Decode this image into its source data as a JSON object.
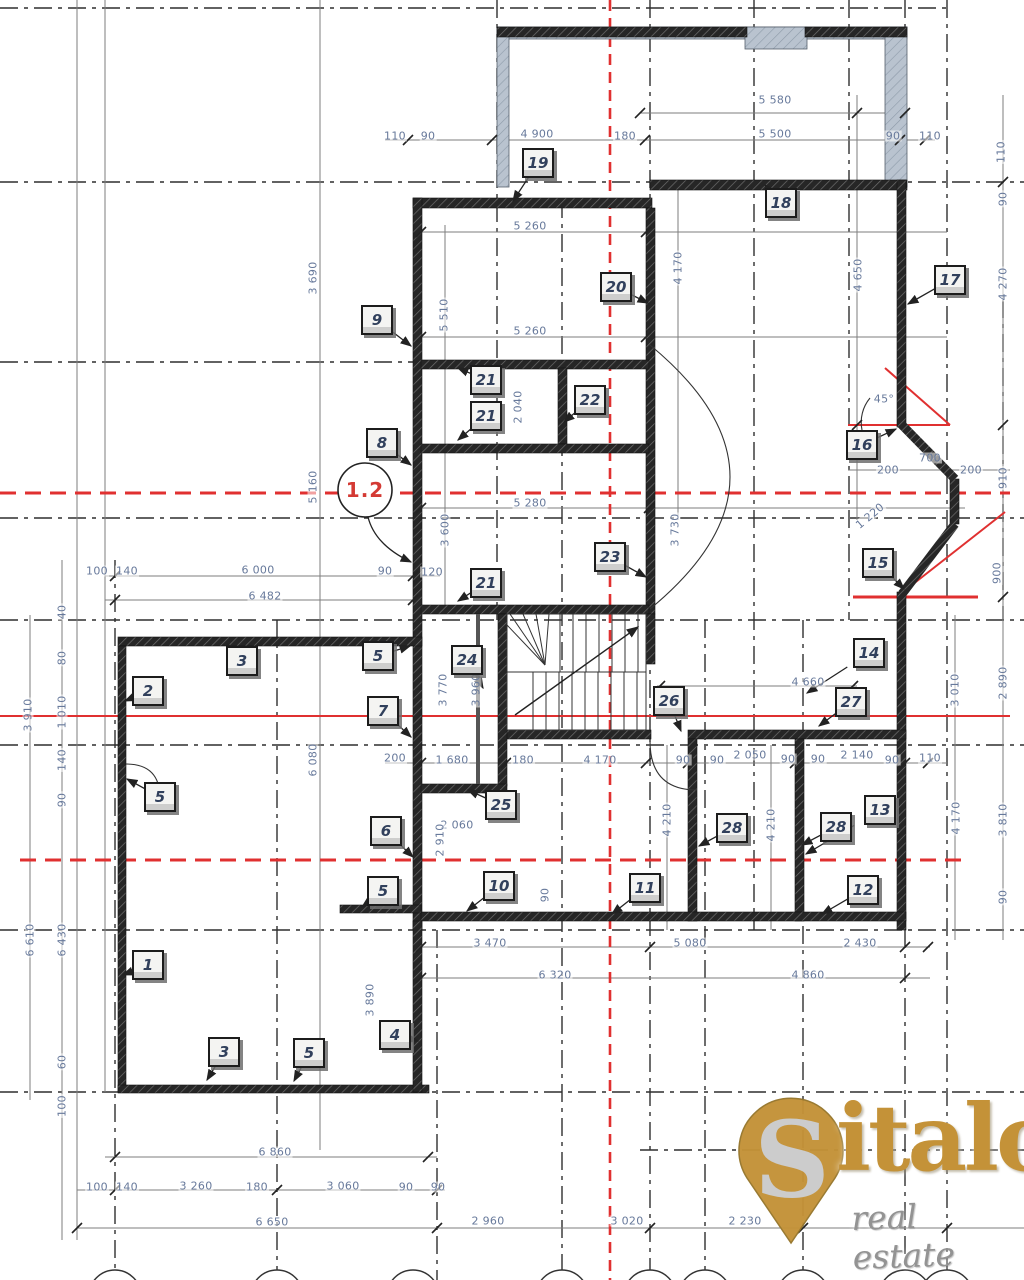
{
  "drawing": {
    "axis_bubble": {
      "label": "1.2"
    },
    "angle_note": "45°",
    "colors": {
      "wall": "#262626",
      "window_wall": "#b9c3cf",
      "axis_red": "#e03030",
      "dim_text": "#67799b",
      "grid": "#2f2f2f"
    },
    "dims": [
      {
        "t": "5 580",
        "x": 775,
        "y": 100,
        "o": "h"
      },
      {
        "t": "110",
        "x": 395,
        "y": 136,
        "o": "h"
      },
      {
        "t": "90",
        "x": 428,
        "y": 136,
        "o": "h"
      },
      {
        "t": "4 900",
        "x": 537,
        "y": 134,
        "o": "h"
      },
      {
        "t": "180",
        "x": 625,
        "y": 136,
        "o": "h"
      },
      {
        "t": "5 500",
        "x": 775,
        "y": 134,
        "o": "h"
      },
      {
        "t": "90",
        "x": 893,
        "y": 136,
        "o": "h"
      },
      {
        "t": "110",
        "x": 930,
        "y": 136,
        "o": "h"
      },
      {
        "t": "5 260",
        "x": 530,
        "y": 226,
        "o": "h"
      },
      {
        "t": "5 260",
        "x": 530,
        "y": 331,
        "o": "h"
      },
      {
        "t": "5 280",
        "x": 530,
        "y": 503,
        "o": "h"
      },
      {
        "t": "100",
        "x": 97,
        "y": 571,
        "o": "h"
      },
      {
        "t": "140",
        "x": 127,
        "y": 571,
        "o": "h"
      },
      {
        "t": "6 000",
        "x": 258,
        "y": 570,
        "o": "h"
      },
      {
        "t": "90",
        "x": 385,
        "y": 571,
        "o": "h"
      },
      {
        "t": "120",
        "x": 432,
        "y": 572,
        "o": "h"
      },
      {
        "t": "6 482",
        "x": 265,
        "y": 596,
        "o": "h"
      },
      {
        "t": "700",
        "x": 930,
        "y": 458,
        "o": "h"
      },
      {
        "t": "200",
        "x": 888,
        "y": 470,
        "o": "h"
      },
      {
        "t": "200",
        "x": 971,
        "y": 470,
        "o": "h"
      },
      {
        "t": "45°",
        "x": 884,
        "y": 399,
        "o": "h"
      },
      {
        "t": "4 660",
        "x": 808,
        "y": 682,
        "o": "h"
      },
      {
        "t": "200",
        "x": 395,
        "y": 758,
        "o": "h"
      },
      {
        "t": "1 680",
        "x": 452,
        "y": 760,
        "o": "h"
      },
      {
        "t": "180",
        "x": 523,
        "y": 760,
        "o": "h"
      },
      {
        "t": "4 170",
        "x": 600,
        "y": 760,
        "o": "h"
      },
      {
        "t": "90",
        "x": 683,
        "y": 760,
        "o": "h"
      },
      {
        "t": "90",
        "x": 717,
        "y": 760,
        "o": "h"
      },
      {
        "t": "2 050",
        "x": 750,
        "y": 755,
        "o": "h"
      },
      {
        "t": "90",
        "x": 788,
        "y": 759,
        "o": "h"
      },
      {
        "t": "90",
        "x": 818,
        "y": 759,
        "o": "h"
      },
      {
        "t": "2 140",
        "x": 857,
        "y": 755,
        "o": "h"
      },
      {
        "t": "90",
        "x": 892,
        "y": 760,
        "o": "h"
      },
      {
        "t": "110",
        "x": 930,
        "y": 758,
        "o": "h"
      },
      {
        "t": "2 060",
        "x": 457,
        "y": 825,
        "o": "h"
      },
      {
        "t": "3 470",
        "x": 490,
        "y": 943,
        "o": "h"
      },
      {
        "t": "5 080",
        "x": 690,
        "y": 943,
        "o": "h"
      },
      {
        "t": "2 430",
        "x": 860,
        "y": 943,
        "o": "h"
      },
      {
        "t": "6 320",
        "x": 555,
        "y": 975,
        "o": "h"
      },
      {
        "t": "4 860",
        "x": 808,
        "y": 975,
        "o": "h"
      },
      {
        "t": "6 860",
        "x": 275,
        "y": 1152,
        "o": "h"
      },
      {
        "t": "100",
        "x": 97,
        "y": 1187,
        "o": "h"
      },
      {
        "t": "140",
        "x": 127,
        "y": 1187,
        "o": "h"
      },
      {
        "t": "3 260",
        "x": 196,
        "y": 1186,
        "o": "h"
      },
      {
        "t": "180",
        "x": 257,
        "y": 1187,
        "o": "h"
      },
      {
        "t": "3 060",
        "x": 343,
        "y": 1186,
        "o": "h"
      },
      {
        "t": "90",
        "x": 406,
        "y": 1187,
        "o": "h"
      },
      {
        "t": "90",
        "x": 438,
        "y": 1187,
        "o": "h"
      },
      {
        "t": "6 650",
        "x": 272,
        "y": 1222,
        "o": "h"
      },
      {
        "t": "2 960",
        "x": 488,
        "y": 1221,
        "o": "h"
      },
      {
        "t": "3 020",
        "x": 627,
        "y": 1221,
        "o": "h"
      },
      {
        "t": "2 230",
        "x": 745,
        "y": 1221,
        "o": "h"
      },
      {
        "t": "3 690",
        "x": 313,
        "y": 278,
        "o": "v"
      },
      {
        "t": "5 510",
        "x": 444,
        "y": 315,
        "o": "v"
      },
      {
        "t": "4 170",
        "x": 678,
        "y": 268,
        "o": "v"
      },
      {
        "t": "4 650",
        "x": 858,
        "y": 275,
        "o": "v"
      },
      {
        "t": "110",
        "x": 1001,
        "y": 152,
        "o": "v"
      },
      {
        "t": "90",
        "x": 1003,
        "y": 199,
        "o": "v"
      },
      {
        "t": "4 270",
        "x": 1003,
        "y": 284,
        "o": "v"
      },
      {
        "t": "2 040",
        "x": 518,
        "y": 407,
        "o": "v"
      },
      {
        "t": "3 600",
        "x": 445,
        "y": 530,
        "o": "v"
      },
      {
        "t": "5 160",
        "x": 313,
        "y": 487,
        "o": "v"
      },
      {
        "t": "3 730",
        "x": 675,
        "y": 530,
        "o": "v"
      },
      {
        "t": "1 220",
        "x": 870,
        "y": 516,
        "o": "d"
      },
      {
        "t": "910",
        "x": 1003,
        "y": 478,
        "o": "v"
      },
      {
        "t": "900",
        "x": 997,
        "y": 573,
        "o": "v"
      },
      {
        "t": "40",
        "x": 62,
        "y": 612,
        "o": "v"
      },
      {
        "t": "80",
        "x": 62,
        "y": 658,
        "o": "v"
      },
      {
        "t": "1 010",
        "x": 62,
        "y": 712,
        "o": "v"
      },
      {
        "t": "140",
        "x": 62,
        "y": 760,
        "o": "v"
      },
      {
        "t": "90",
        "x": 62,
        "y": 800,
        "o": "v"
      },
      {
        "t": "3 910",
        "x": 28,
        "y": 715,
        "o": "v"
      },
      {
        "t": "6 080",
        "x": 313,
        "y": 760,
        "o": "v"
      },
      {
        "t": "3 770",
        "x": 443,
        "y": 690,
        "o": "v"
      },
      {
        "t": "3 960",
        "x": 476,
        "y": 690,
        "o": "v"
      },
      {
        "t": "2 910",
        "x": 440,
        "y": 840,
        "o": "v"
      },
      {
        "t": "90",
        "x": 545,
        "y": 895,
        "o": "v"
      },
      {
        "t": "4 210",
        "x": 667,
        "y": 820,
        "o": "v"
      },
      {
        "t": "4 210",
        "x": 771,
        "y": 825,
        "o": "v"
      },
      {
        "t": "2 890",
        "x": 1003,
        "y": 683,
        "o": "v"
      },
      {
        "t": "3 010",
        "x": 955,
        "y": 690,
        "o": "v"
      },
      {
        "t": "4 170",
        "x": 956,
        "y": 818,
        "o": "v"
      },
      {
        "t": "3 810",
        "x": 1003,
        "y": 820,
        "o": "v"
      },
      {
        "t": "90",
        "x": 1003,
        "y": 897,
        "o": "v"
      },
      {
        "t": "3 890",
        "x": 370,
        "y": 1000,
        "o": "v"
      },
      {
        "t": "6 610",
        "x": 30,
        "y": 940,
        "o": "v"
      },
      {
        "t": "6 430",
        "x": 62,
        "y": 940,
        "o": "v"
      },
      {
        "t": "60",
        "x": 62,
        "y": 1062,
        "o": "v"
      },
      {
        "t": "100",
        "x": 62,
        "y": 1106,
        "o": "v"
      }
    ],
    "labels": [
      {
        "n": "19",
        "x": 538,
        "y": 163,
        "lx": -25,
        "ly": 38
      },
      {
        "n": "18",
        "x": 781,
        "y": 203,
        "lx": -16,
        "ly": -18
      },
      {
        "n": "9",
        "x": 377,
        "y": 320,
        "lx": 34,
        "ly": 26
      },
      {
        "n": "20",
        "x": 616,
        "y": 287,
        "lx": 32,
        "ly": 16
      },
      {
        "n": "17",
        "x": 950,
        "y": 280,
        "lx": -42,
        "ly": 24
      },
      {
        "n": "21",
        "x": 486,
        "y": 380,
        "lx": -28,
        "ly": -12
      },
      {
        "n": "21",
        "x": 486,
        "y": 416,
        "lx": -28,
        "ly": 24
      },
      {
        "n": "22",
        "x": 590,
        "y": 400,
        "lx": -26,
        "ly": 22
      },
      {
        "n": "16",
        "x": 862,
        "y": 445,
        "lx": 34,
        "ly": -16
      },
      {
        "n": "8",
        "x": 382,
        "y": 443,
        "lx": 29,
        "ly": 22
      },
      {
        "n": "23",
        "x": 610,
        "y": 557,
        "lx": 36,
        "ly": 20
      },
      {
        "n": "15",
        "x": 878,
        "y": 563,
        "lx": 26,
        "ly": 26
      },
      {
        "n": "21",
        "x": 486,
        "y": 583,
        "lx": -28,
        "ly": 18
      },
      {
        "n": "3",
        "x": 242,
        "y": 661,
        "lx": -15,
        "ly": -17
      },
      {
        "n": "2",
        "x": 148,
        "y": 691,
        "lx": -23,
        "ly": 10
      },
      {
        "n": "5",
        "x": 378,
        "y": 656,
        "lx": 32,
        "ly": -10
      },
      {
        "n": "14",
        "x": 869,
        "y": 653,
        "lx": -62,
        "ly": 40
      },
      {
        "n": "24",
        "x": 467,
        "y": 660,
        "lx": 16,
        "ly": 28
      },
      {
        "n": "26",
        "x": 669,
        "y": 701,
        "lx": 12,
        "ly": 30
      },
      {
        "n": "27",
        "x": 851,
        "y": 702,
        "lx": -32,
        "ly": 24
      },
      {
        "n": "7",
        "x": 383,
        "y": 711,
        "lx": 28,
        "ly": 26
      },
      {
        "n": "5",
        "x": 160,
        "y": 797,
        "lx": -33,
        "ly": -18
      },
      {
        "n": "25",
        "x": 501,
        "y": 805,
        "lx": -33,
        "ly": -15
      },
      {
        "n": "6",
        "x": 386,
        "y": 831,
        "lx": 27,
        "ly": 26
      },
      {
        "n": "13",
        "x": 880,
        "y": 810,
        "lx": -74,
        "ly": 44
      },
      {
        "n": "28",
        "x": 732,
        "y": 828,
        "lx": -33,
        "ly": 18
      },
      {
        "n": "28",
        "x": 836,
        "y": 827,
        "lx": -34,
        "ly": 18
      },
      {
        "n": "5",
        "x": 383,
        "y": 891,
        "lx": -21,
        "ly": 16
      },
      {
        "n": "10",
        "x": 499,
        "y": 886,
        "lx": -32,
        "ly": 25
      },
      {
        "n": "11",
        "x": 645,
        "y": 888,
        "lx": -33,
        "ly": 26
      },
      {
        "n": "12",
        "x": 863,
        "y": 890,
        "lx": -41,
        "ly": 24
      },
      {
        "n": "1",
        "x": 148,
        "y": 965,
        "lx": -25,
        "ly": 10
      },
      {
        "n": "4",
        "x": 395,
        "y": 1035,
        "lx": 23,
        "ly": 6
      },
      {
        "n": "3",
        "x": 224,
        "y": 1052,
        "lx": -17,
        "ly": 28
      },
      {
        "n": "5",
        "x": 309,
        "y": 1053,
        "lx": -15,
        "ly": 28
      }
    ],
    "logo": {
      "brand": "Sitalo",
      "brand_initial": "S",
      "brand_rest": "italo",
      "tagline": "real estate"
    }
  }
}
